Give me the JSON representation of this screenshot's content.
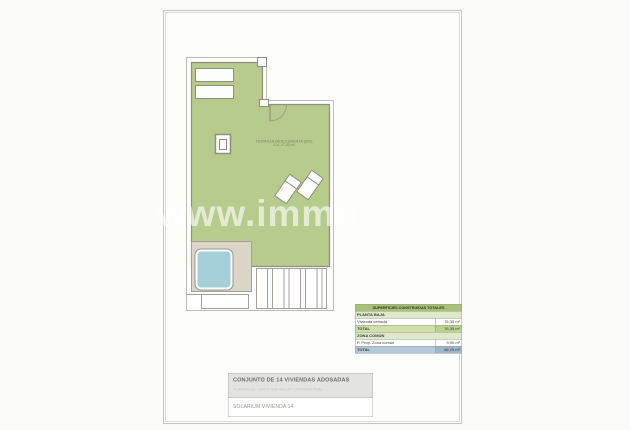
{
  "watermark": "www.immo",
  "plan": {
    "room_label_line1": "TERRAZA DESCUBIERTA (8%)",
    "room_label_line2": "S.U. 47,30 m²"
  },
  "surfaces_table": {
    "title": "SUPERFICIES CONSTRUIDAS TOTALES",
    "rows": [
      {
        "label": "PLANTA BAJA",
        "value": ""
      },
      {
        "label": "Vivienda cerrada",
        "value": "76,35 m²"
      },
      {
        "label": "TOTAL",
        "value": "76,35 m²"
      },
      {
        "label": "ZONA COMÚN",
        "value": ""
      },
      {
        "label": "P. Prop. Zona común",
        "value": "9,90 m²"
      },
      {
        "label": "TOTAL",
        "value": "86,25 m²"
      }
    ]
  },
  "title_block": {
    "project": "CONJUNTO DE 14 VIVIENDAS ADOSADAS",
    "disclaimer": "PLANOS DE VENTA SIN VALOR CONTRACTUAL",
    "drawing": "SOLARIUM VIVIENDA 14"
  },
  "colors": {
    "terrace_green": "#b7cb8c",
    "pool_blue": "#a5cfd8",
    "deck_beige": "#d9d5c7",
    "table_header_green": "#a5c276",
    "total_blue": "#9cb6d0"
  }
}
